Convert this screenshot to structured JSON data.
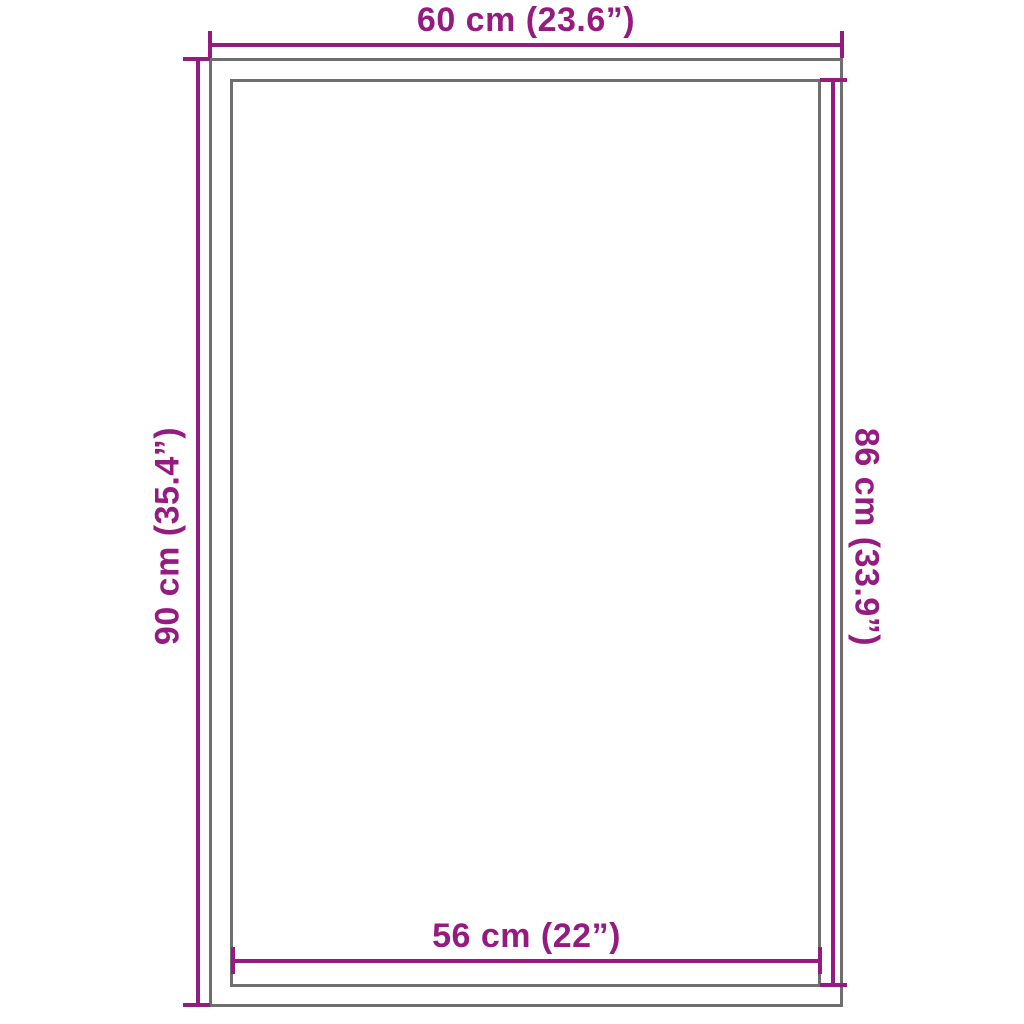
{
  "diagram": {
    "title": "Rug dimension diagram",
    "colors": {
      "dimension": "#951B81",
      "outline": "#706F70",
      "background": "#FFFFFF"
    },
    "dimensions": {
      "top": {
        "label": "60 cm (23.6”)",
        "cm": 60,
        "inches": 23.6,
        "measures": "outer width"
      },
      "left": {
        "label": "90 cm (35.4”)",
        "cm": 90,
        "inches": 35.4,
        "measures": "outer height"
      },
      "right": {
        "label": "86 cm (33.9”)",
        "cm": 86,
        "inches": 33.9,
        "measures": "inner height"
      },
      "bottom": {
        "label": "56 cm (22”)",
        "cm": 56,
        "inches": 22,
        "measures": "inner width"
      }
    }
  }
}
